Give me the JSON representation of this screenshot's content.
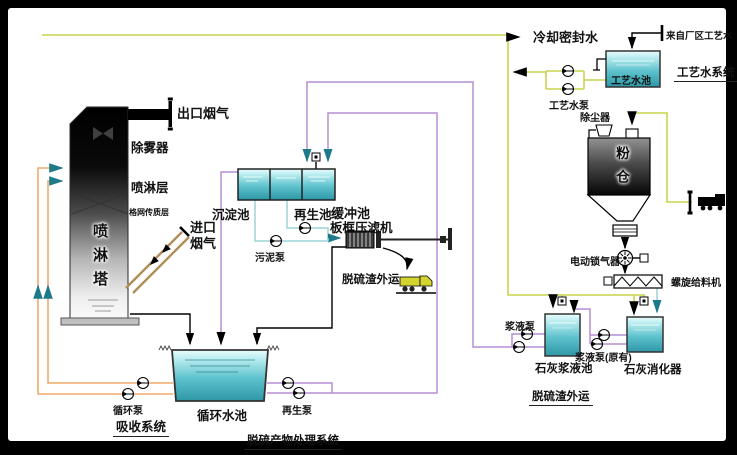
{
  "colors": {
    "process_water_line": "#c9d34f",
    "circulating_line": "#f2a96b",
    "slurry_line": "#b78ed6",
    "sludge_line": "#9ad4d8",
    "duct_line": "#b08d5a",
    "tank_fill": "#5fc3cd",
    "arrow_teal": "#1d7a8a",
    "frame": "#000000"
  },
  "tower": {
    "title": "喷淋塔",
    "outlet_gas": "出口烟气",
    "demister": "除雾器",
    "spray_layer": "喷淋层",
    "grid_layer": "格网传质层",
    "inlet_gas_line1": "进口",
    "inlet_gas_line2": "烟气"
  },
  "treatment": {
    "sedimentation_tank": "沉淀池",
    "regeneration_tank": "再生池",
    "buffer_tank": "缓冲池",
    "filter_press": "板框压滤机",
    "sludge_pump": "污泥泵",
    "slag_transport": "脱硫渣外运",
    "system_title": "脱硫产物处理系统"
  },
  "absorption": {
    "circulating_pool": "循环水池",
    "circulating_pump": "循环泵",
    "regeneration_pump": "再生泵",
    "system_title": "吸收系统"
  },
  "process_water": {
    "cooling_seal_water": "冷却密封水",
    "from_plant": "来自厂区工艺水",
    "pool": "工艺水池",
    "pump": "工艺水泵",
    "system_title": "工艺水系统"
  },
  "lime": {
    "dust_collector": "除尘器",
    "silo": "粉仓",
    "rotary_airlock": "电动锁气器",
    "screw_feeder": "螺旋给料机",
    "slurry_pump": "浆液泵",
    "slurry_pool": "石灰浆液池",
    "slurry_pump_original": "浆液泵(原有)",
    "digester": "石灰消化器",
    "slag_transport_title": "脱硫渣外运"
  }
}
